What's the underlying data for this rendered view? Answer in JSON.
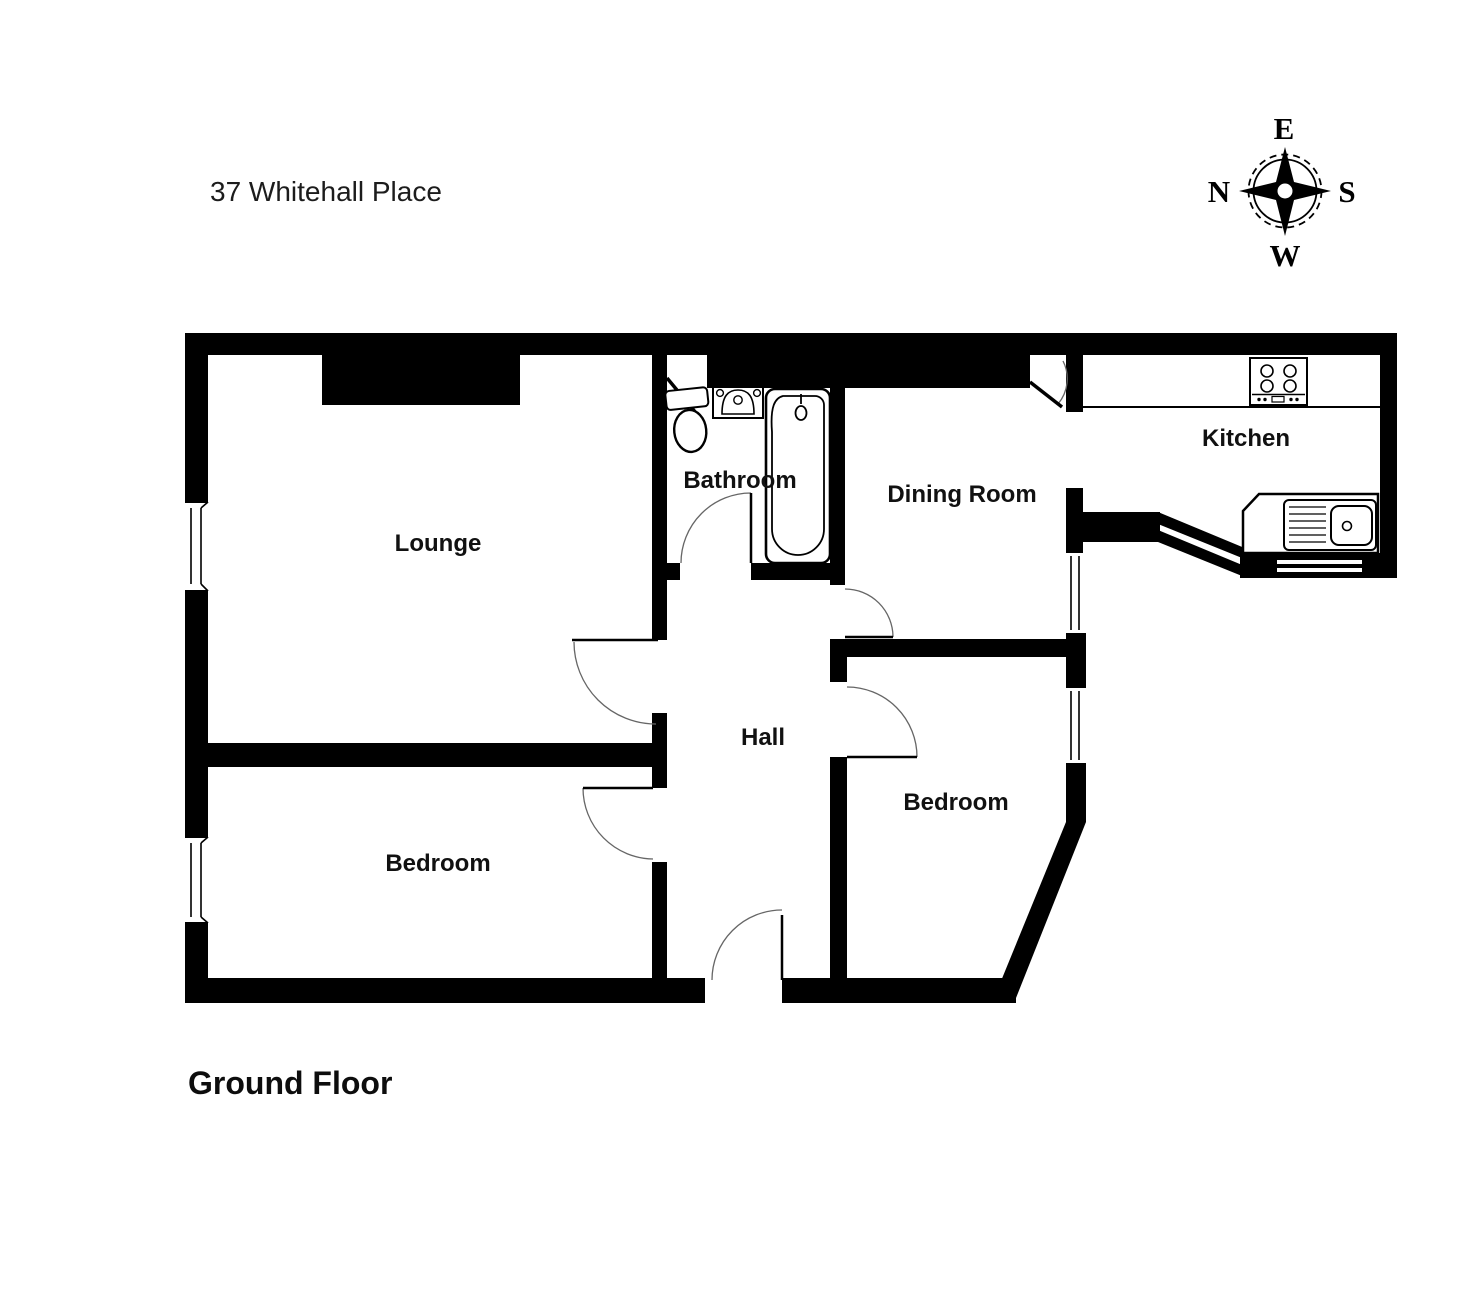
{
  "title": "37 Whitehall Place",
  "floor_label": "Ground Floor",
  "compass": {
    "top": "E",
    "left": "N",
    "right": "S",
    "bottom": "W"
  },
  "rooms": {
    "lounge": {
      "label": "Lounge"
    },
    "bathroom": {
      "label": "Bathroom"
    },
    "dining_room": {
      "label": "Dining Room"
    },
    "kitchen": {
      "label": "Kitchen"
    },
    "hall": {
      "label": "Hall"
    },
    "bedroom_left": {
      "label": "Bedroom"
    },
    "bedroom_right": {
      "label": "Bedroom"
    }
  },
  "fixtures": [
    "toilet-icon",
    "basin-icon",
    "bathtub-icon",
    "hob-icon",
    "kitchen-sink-icon"
  ],
  "colors": {
    "wall": "#000000",
    "background": "#ffffff",
    "door_arc": "#666666"
  }
}
